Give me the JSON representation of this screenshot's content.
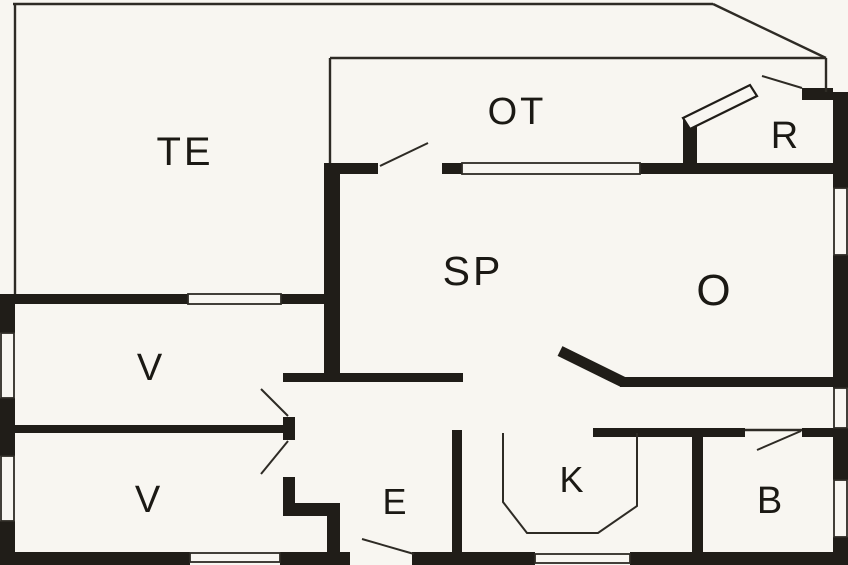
{
  "floorplan": {
    "canvas": {
      "width": 848,
      "height": 565
    },
    "background": "#f8f6f1",
    "wall_color": "#201d18",
    "line_color": "#2e2b25",
    "rooms": [
      {
        "id": "te",
        "label": "TE",
        "x": 185,
        "y": 165,
        "font_size": 40
      },
      {
        "id": "ot",
        "label": "OT",
        "x": 517,
        "y": 124,
        "font_size": 38
      },
      {
        "id": "r",
        "label": "R",
        "x": 786,
        "y": 148,
        "font_size": 38
      },
      {
        "id": "sp",
        "label": "SP",
        "x": 473,
        "y": 285,
        "font_size": 41
      },
      {
        "id": "o",
        "label": "O",
        "x": 715,
        "y": 305,
        "font_size": 44
      },
      {
        "id": "v-upper",
        "label": "V",
        "x": 151,
        "y": 380,
        "font_size": 38
      },
      {
        "id": "v-lower",
        "label": "V",
        "x": 149,
        "y": 512,
        "font_size": 38
      },
      {
        "id": "e",
        "label": "E",
        "x": 396,
        "y": 514,
        "font_size": 36
      },
      {
        "id": "k",
        "label": "K",
        "x": 573,
        "y": 492,
        "font_size": 36
      },
      {
        "id": "b",
        "label": "B",
        "x": 771,
        "y": 513,
        "font_size": 38
      }
    ],
    "walls": [
      [
        0,
        294,
        15,
        39
      ],
      [
        0,
        398,
        15,
        58
      ],
      [
        0,
        521,
        15,
        44
      ],
      [
        0,
        552,
        190,
        13
      ],
      [
        280,
        552,
        70,
        13
      ],
      [
        412,
        552,
        123,
        13
      ],
      [
        630,
        552,
        218,
        13
      ],
      [
        833,
        92,
        15,
        96
      ],
      [
        833,
        255,
        15,
        133
      ],
      [
        833,
        428,
        15,
        52
      ],
      [
        833,
        537,
        15,
        28
      ],
      [
        0,
        294,
        188,
        10
      ],
      [
        281,
        294,
        59,
        10
      ],
      [
        0,
        425,
        295,
        8
      ],
      [
        324,
        163,
        16,
        215
      ],
      [
        330,
        163,
        48,
        11
      ],
      [
        442,
        163,
        20,
        11
      ],
      [
        640,
        163,
        208,
        11
      ],
      [
        683,
        120,
        14,
        54
      ],
      [
        802,
        88,
        31,
        12
      ],
      [
        283,
        373,
        180,
        9
      ],
      [
        283,
        417,
        12,
        23
      ],
      [
        283,
        477,
        12,
        30
      ],
      [
        283,
        503,
        57,
        13
      ],
      [
        327,
        516,
        13,
        37
      ],
      [
        452,
        430,
        10,
        123
      ],
      [
        593,
        428,
        152,
        9
      ],
      [
        692,
        428,
        11,
        125
      ],
      [
        802,
        428,
        31,
        9
      ],
      [
        620,
        377,
        213,
        10
      ]
    ],
    "diagonal_walls": [
      {
        "x1": 560,
        "y1": 351,
        "x2": 623,
        "y2": 382,
        "width": 11
      }
    ],
    "windows": [
      [
        1,
        333,
        13,
        65
      ],
      [
        1,
        456,
        13,
        65
      ],
      [
        188,
        294,
        93,
        10
      ],
      [
        462,
        163,
        178,
        11
      ],
      [
        834,
        188,
        13,
        67
      ],
      [
        834,
        388,
        13,
        40
      ],
      [
        834,
        480,
        13,
        57
      ],
      [
        190,
        553,
        90,
        9
      ],
      [
        535,
        554,
        95,
        9
      ]
    ],
    "thin_lines": [
      [
        13,
        4,
        713,
        4
      ],
      [
        713,
        4,
        826,
        58
      ],
      [
        330,
        58,
        826,
        58
      ],
      [
        826,
        58,
        826,
        92
      ],
      [
        330,
        58,
        330,
        163
      ],
      [
        15,
        4,
        15,
        294
      ],
      [
        745,
        430,
        802,
        430
      ]
    ],
    "door_swings": [
      [
        380,
        166,
        428,
        143
      ],
      [
        288,
        416,
        261,
        389
      ],
      [
        288,
        441,
        261,
        474
      ],
      [
        362,
        539,
        414,
        554
      ],
      [
        757,
        450,
        801,
        431
      ],
      [
        762,
        76,
        802,
        88
      ]
    ],
    "door_leaf_polygon": "683,118 750,85 757,96 690,129",
    "counter_polyline": "503,433 503,502 527,533 598,533 637,506 637,433"
  }
}
